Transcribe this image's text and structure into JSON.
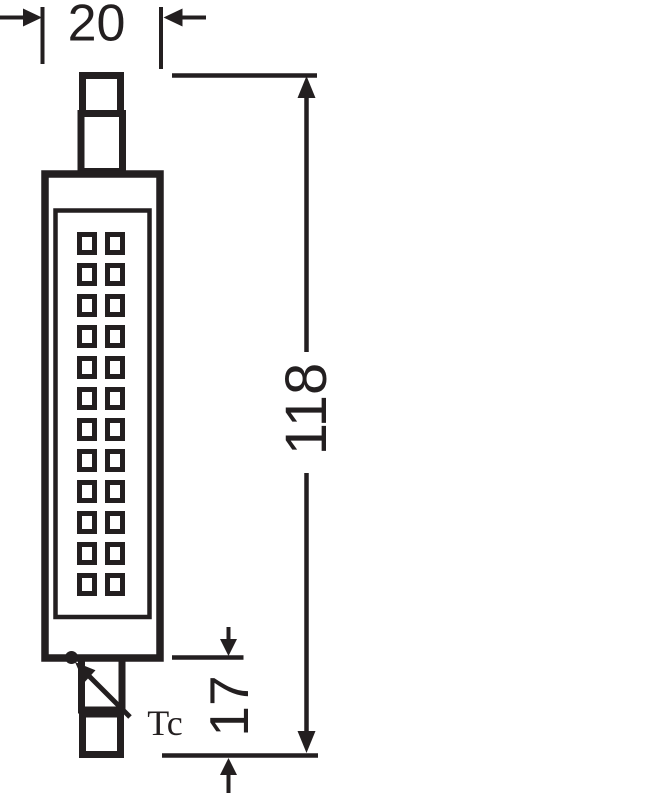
{
  "figure": {
    "background_color": "#ffffff",
    "line_color": "#231f20"
  },
  "dimensions": {
    "width_mm": {
      "value": "20"
    },
    "length_mm": {
      "value": "118"
    },
    "tc_offset_mm": {
      "value": "17"
    }
  },
  "labels": {
    "tc_point": "Tc"
  },
  "lamp": {
    "led_grid": {
      "rows": 12,
      "columns": 2
    }
  }
}
